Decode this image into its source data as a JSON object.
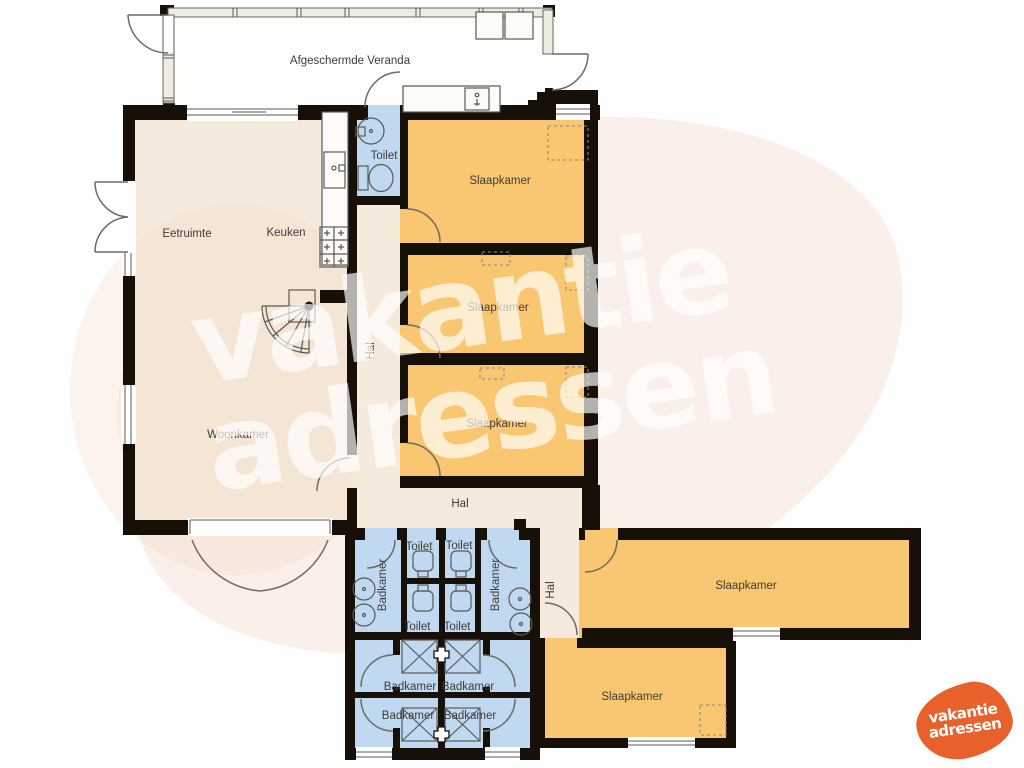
{
  "plan": {
    "labels": [
      {
        "text": "Afgeschermde Veranda"
      },
      {
        "text": "Eetruimte"
      },
      {
        "text": "Keuken"
      },
      {
        "text": "Toilet"
      },
      {
        "text": "Slaapkamer"
      },
      {
        "text": "Slaapkamer"
      },
      {
        "text": "Hal"
      },
      {
        "text": "Slaapkamer"
      },
      {
        "text": "Woonkamer"
      },
      {
        "text": "Hal"
      },
      {
        "text": "Toilet"
      },
      {
        "text": "Toilet"
      },
      {
        "text": "Badkamer"
      },
      {
        "text": "Badkamer"
      },
      {
        "text": "Hal"
      },
      {
        "text": "Slaapkamer"
      },
      {
        "text": "Toilet"
      },
      {
        "text": "Toilet"
      },
      {
        "text": "Badkamer"
      },
      {
        "text": "Badkamer"
      },
      {
        "text": "Slaapkamer"
      },
      {
        "text": "Badkamer"
      },
      {
        "text": "Badkamer"
      }
    ]
  },
  "watermark": {
    "line1": "vakantie",
    "line2": "adressen"
  },
  "logo": {
    "line1": "vakantie",
    "line2": "adressen"
  },
  "colors": {
    "bedroom": "#F9C672",
    "living": "#F5EADC",
    "bathroom": "#C0D9F0",
    "wall": "#161008",
    "door_line": "#6E6B64",
    "label_text": "#3E3C38",
    "blob_tint": "#F6D8C8",
    "logo_orange": "#E8602A"
  }
}
